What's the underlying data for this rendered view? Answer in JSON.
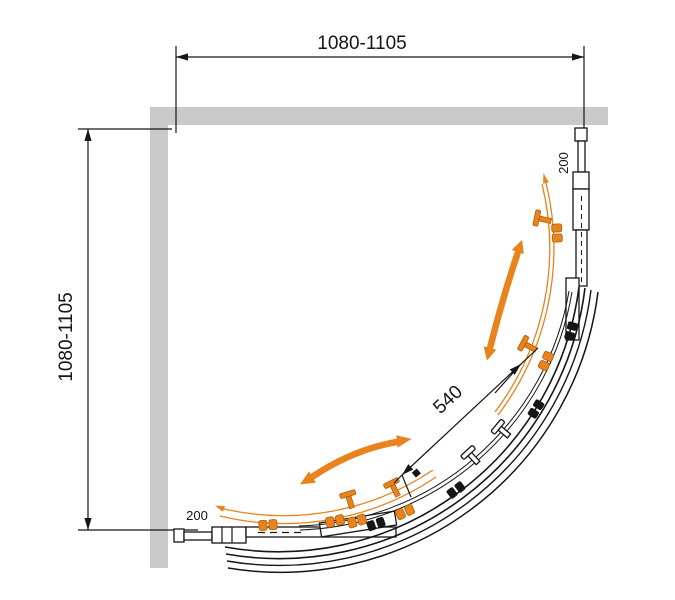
{
  "title": "Quadrant shower enclosure - top view technical drawing",
  "dimensions": {
    "top_width": "1080-1105",
    "left_height": "1080-1105",
    "door_opening": "540",
    "top_profile_adjustment": "200",
    "bottom_profile_adjustment": "200"
  },
  "colors": {
    "accent_orange": "#E8831E",
    "accent_orange_dark": "#B05E08",
    "wall_gray": "#C9C9C9",
    "line_black": "#161616"
  }
}
